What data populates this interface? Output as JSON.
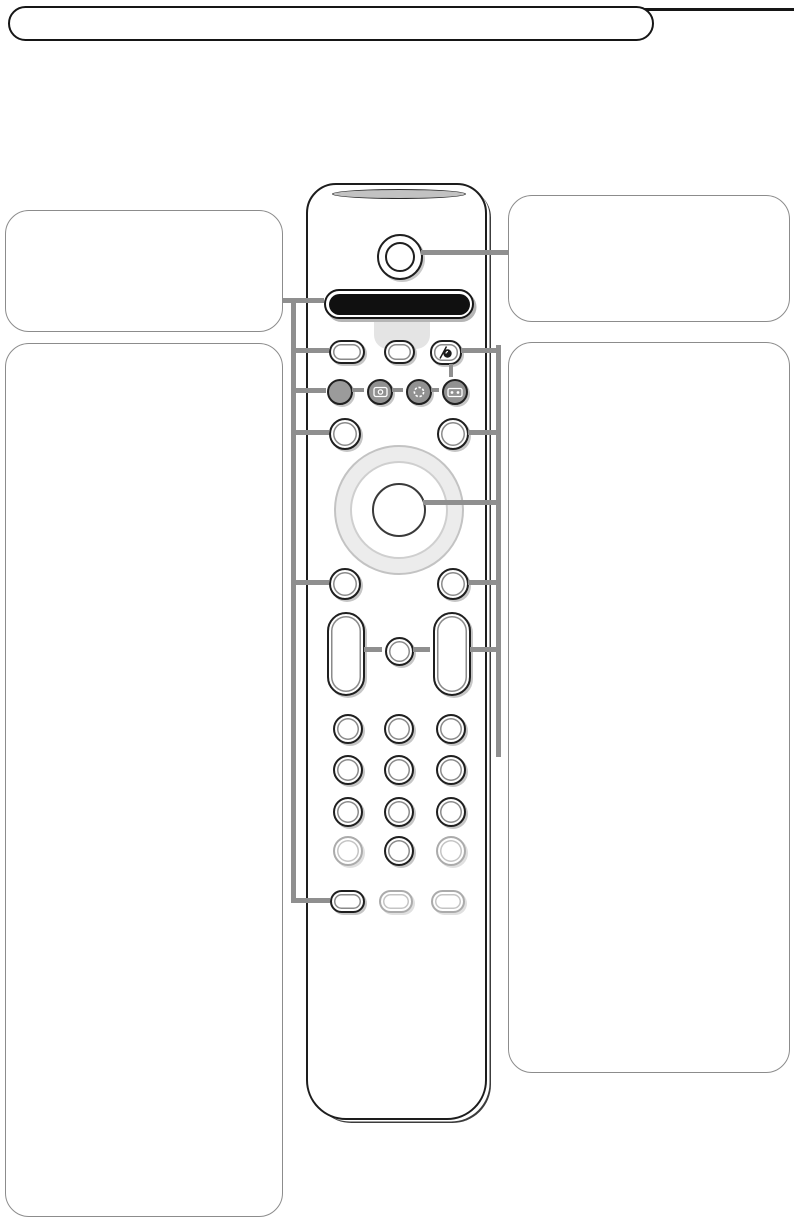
{
  "banner": {
    "title": ""
  },
  "callouts": {
    "top_left": {
      "text": ""
    },
    "bottom_left": {
      "text": ""
    },
    "top_right": {
      "text": ""
    },
    "bottom_right": {
      "text": ""
    }
  },
  "remote": {
    "device": "tv-remote-control",
    "top_buttons": [
      "power-button",
      "display-window",
      "pill-button-left",
      "pill-button-middle",
      "active-control-button"
    ],
    "mode_buttons": [
      {
        "icon": "solid-gray-mode-icon"
      },
      {
        "icon": "monitor-icon"
      },
      {
        "icon": "dish-circle-icon"
      },
      {
        "icon": "vcr-cassette-icon"
      }
    ],
    "navigation": [
      "menu-button-left",
      "menu-button-right",
      "cursor-ring",
      "ok-button"
    ],
    "rockers": [
      "volume-rocker",
      "mute-button",
      "program-rocker"
    ],
    "keypad_rows": 4,
    "keypad_cols": 3,
    "bottom_buttons": [
      "bottom-pill-1",
      "bottom-pill-2",
      "bottom-pill-3"
    ]
  },
  "colors": {
    "connector_line": "#8f8f8f",
    "remote_outline": "#1d1d1d",
    "box_border": "#8c8c8c",
    "display_fill": "#101010",
    "mode_button_fill": "#919191",
    "tab_fill": "#e4e4e4",
    "light_button_border": "#ababab",
    "ring_fill": "#ececec"
  }
}
